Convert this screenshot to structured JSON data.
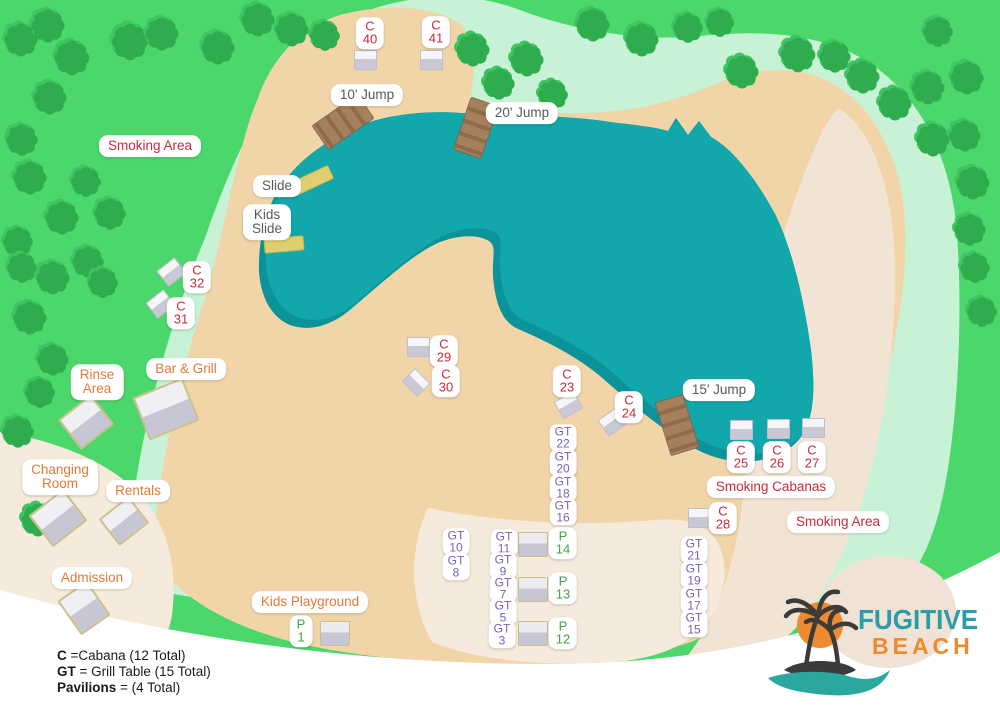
{
  "logo": {
    "line1": "FUGITIVE",
    "line2": "BEACH"
  },
  "legend": {
    "items": [
      {
        "term": "C",
        "rest": " =Cabana (12 Total)"
      },
      {
        "term": "GT",
        "rest": " = Grill Table (15 Total)"
      },
      {
        "term": "Pavilions",
        "rest": " = (4 Total)"
      }
    ]
  },
  "colors": {
    "grass": "#4BD76C",
    "tree": "#2FAC4E",
    "tree_halo": "#3EC562",
    "mint": "#C8F2D6",
    "sand": "#F1D5A9",
    "path_light": "#F5E9DB",
    "water": "#12A7AA",
    "water_deep": "#0C9399",
    "dock": "#A6805D",
    "slide": "#DFCF6E",
    "cabana_label": "#C62B3E",
    "facility_label": "#E07B39",
    "grill_table_label": "#7A5FB5",
    "pavilion_label": "#3FA344",
    "feature_label": "#57585A",
    "logo_teal": "#2A9DA8",
    "logo_orange": "#EE8A2F"
  },
  "map": {
    "labels": [
      {
        "id": "c40",
        "cls": "red",
        "x": 370,
        "y": 33,
        "lines": [
          "C",
          "40"
        ]
      },
      {
        "id": "c41",
        "cls": "red",
        "x": 436,
        "y": 32,
        "lines": [
          "C",
          "41"
        ]
      },
      {
        "id": "c32",
        "cls": "red",
        "x": 197,
        "y": 277,
        "lines": [
          "C",
          "32"
        ]
      },
      {
        "id": "c31",
        "cls": "red",
        "x": 181,
        "y": 313,
        "lines": [
          "C",
          "31"
        ]
      },
      {
        "id": "c29",
        "cls": "red",
        "x": 444,
        "y": 351,
        "lines": [
          "C",
          "29"
        ]
      },
      {
        "id": "c30",
        "cls": "red",
        "x": 446,
        "y": 381,
        "lines": [
          "C",
          "30"
        ]
      },
      {
        "id": "c23",
        "cls": "red",
        "x": 567,
        "y": 381,
        "lines": [
          "C",
          "23"
        ]
      },
      {
        "id": "c24",
        "cls": "red",
        "x": 629,
        "y": 407,
        "lines": [
          "C",
          "24"
        ]
      },
      {
        "id": "c25",
        "cls": "red",
        "x": 741,
        "y": 457,
        "lines": [
          "C",
          "25"
        ]
      },
      {
        "id": "c26",
        "cls": "red",
        "x": 777,
        "y": 457,
        "lines": [
          "C",
          "26"
        ]
      },
      {
        "id": "c27",
        "cls": "red",
        "x": 812,
        "y": 457,
        "lines": [
          "C",
          "27"
        ]
      },
      {
        "id": "c28",
        "cls": "red",
        "x": 723,
        "y": 518,
        "lines": [
          "C",
          "28"
        ]
      },
      {
        "id": "gt22",
        "cls": "purple small",
        "x": 563,
        "y": 438,
        "lines": [
          "GT",
          "22"
        ]
      },
      {
        "id": "gt20",
        "cls": "purple small",
        "x": 563,
        "y": 463,
        "lines": [
          "GT",
          "20"
        ]
      },
      {
        "id": "gt18",
        "cls": "purple small",
        "x": 563,
        "y": 488,
        "lines": [
          "GT",
          "18"
        ]
      },
      {
        "id": "gt16",
        "cls": "purple small",
        "x": 563,
        "y": 512,
        "lines": [
          "GT",
          "16"
        ]
      },
      {
        "id": "gt10",
        "cls": "purple small",
        "x": 456,
        "y": 542,
        "lines": [
          "GT",
          "10"
        ]
      },
      {
        "id": "gt8",
        "cls": "purple small",
        "x": 456,
        "y": 567,
        "lines": [
          "GT",
          "8"
        ]
      },
      {
        "id": "gt11",
        "cls": "purple small",
        "x": 504,
        "y": 543,
        "lines": [
          "GT",
          "11"
        ]
      },
      {
        "id": "gt9",
        "cls": "purple small",
        "x": 503,
        "y": 566,
        "lines": [
          "GT",
          "9"
        ]
      },
      {
        "id": "gt7",
        "cls": "purple small",
        "x": 503,
        "y": 589,
        "lines": [
          "GT",
          "7"
        ]
      },
      {
        "id": "gt5",
        "cls": "purple small",
        "x": 503,
        "y": 612,
        "lines": [
          "GT",
          "5"
        ]
      },
      {
        "id": "gt3",
        "cls": "purple small",
        "x": 502,
        "y": 635,
        "lines": [
          "GT",
          "3"
        ]
      },
      {
        "id": "gt21",
        "cls": "purple small",
        "x": 694,
        "y": 550,
        "lines": [
          "GT",
          "21"
        ]
      },
      {
        "id": "gt19",
        "cls": "purple small",
        "x": 694,
        "y": 575,
        "lines": [
          "GT",
          "19"
        ]
      },
      {
        "id": "gt17",
        "cls": "purple small",
        "x": 694,
        "y": 600,
        "lines": [
          "GT",
          "17"
        ]
      },
      {
        "id": "gt15",
        "cls": "purple small",
        "x": 694,
        "y": 624,
        "lines": [
          "GT",
          "15"
        ]
      },
      {
        "id": "p1",
        "cls": "green",
        "x": 301,
        "y": 631,
        "lines": [
          "P",
          "1"
        ]
      },
      {
        "id": "p14",
        "cls": "green",
        "x": 563,
        "y": 543,
        "lines": [
          "P",
          "14"
        ]
      },
      {
        "id": "p13",
        "cls": "green",
        "x": 563,
        "y": 588,
        "lines": [
          "P",
          "13"
        ]
      },
      {
        "id": "p12",
        "cls": "green",
        "x": 563,
        "y": 633,
        "lines": [
          "P",
          "12"
        ]
      },
      {
        "id": "smoking-area-west",
        "cls": "red wide",
        "x": 150,
        "y": 146,
        "lines": [
          "Smoking Area"
        ]
      },
      {
        "id": "smoking-cabanas",
        "cls": "red wide",
        "x": 771,
        "y": 487,
        "lines": [
          "Smoking Cabanas"
        ]
      },
      {
        "id": "smoking-area-east",
        "cls": "red wide",
        "x": 838,
        "y": 522,
        "lines": [
          "Smoking Area"
        ]
      },
      {
        "id": "rinse-area",
        "cls": "orange wide",
        "x": 97,
        "y": 382,
        "lines": [
          "Rinse",
          "Area"
        ]
      },
      {
        "id": "bar-and-grill",
        "cls": "orange wide",
        "x": 186,
        "y": 369,
        "lines": [
          "Bar & Grill"
        ]
      },
      {
        "id": "changing-room",
        "cls": "orange wide",
        "x": 60,
        "y": 477,
        "lines": [
          "Changing",
          "Room"
        ]
      },
      {
        "id": "rentals",
        "cls": "orange wide",
        "x": 138,
        "y": 491,
        "lines": [
          "Rentals"
        ]
      },
      {
        "id": "admission",
        "cls": "orange wide",
        "x": 92,
        "y": 578,
        "lines": [
          "Admission"
        ]
      },
      {
        "id": "kids-playground",
        "cls": "orange wide",
        "x": 310,
        "y": 602,
        "lines": [
          "Kids Playground"
        ]
      },
      {
        "id": "jump-10",
        "cls": "gray wide",
        "x": 367,
        "y": 95,
        "lines": [
          "10' Jump"
        ]
      },
      {
        "id": "jump-20",
        "cls": "gray wide",
        "x": 522,
        "y": 113,
        "lines": [
          "20' Jump"
        ]
      },
      {
        "id": "jump-15",
        "cls": "gray wide",
        "x": 719,
        "y": 390,
        "lines": [
          "15' Jump"
        ]
      },
      {
        "id": "slide",
        "cls": "gray wide",
        "x": 277,
        "y": 186,
        "lines": [
          "Slide"
        ]
      },
      {
        "id": "kids-slide",
        "cls": "gray wide",
        "x": 267,
        "y": 222,
        "lines": [
          "Kids",
          "Slide"
        ]
      }
    ],
    "structures": [
      {
        "id": "c40",
        "type": "cabana",
        "x": 364,
        "y": 59,
        "w": 21,
        "h": 18,
        "r": 0
      },
      {
        "id": "c41",
        "type": "cabana",
        "x": 430,
        "y": 59,
        "w": 21,
        "h": 18,
        "r": 0
      },
      {
        "id": "c32",
        "type": "cabana",
        "x": 170,
        "y": 271,
        "w": 21,
        "h": 18,
        "r": -38
      },
      {
        "id": "c31",
        "type": "cabana",
        "x": 159,
        "y": 303,
        "w": 21,
        "h": 18,
        "r": -38
      },
      {
        "id": "c29",
        "type": "cabana",
        "x": 417,
        "y": 346,
        "w": 21,
        "h": 18,
        "r": 0
      },
      {
        "id": "c30",
        "type": "cabana",
        "x": 415,
        "y": 381,
        "w": 20,
        "h": 17,
        "r": 45
      },
      {
        "id": "c23",
        "type": "cabana",
        "x": 567,
        "y": 404,
        "w": 21,
        "h": 18,
        "r": -30
      },
      {
        "id": "c24",
        "type": "cabana",
        "x": 611,
        "y": 421,
        "w": 21,
        "h": 18,
        "r": -35
      },
      {
        "id": "c25",
        "type": "cabana",
        "x": 740,
        "y": 429,
        "w": 21,
        "h": 18,
        "r": 0
      },
      {
        "id": "c26",
        "type": "cabana",
        "x": 777,
        "y": 428,
        "w": 21,
        "h": 18,
        "r": 0
      },
      {
        "id": "c27",
        "type": "cabana",
        "x": 812,
        "y": 427,
        "w": 21,
        "h": 18,
        "r": 0
      },
      {
        "id": "c28",
        "type": "cabana",
        "x": 698,
        "y": 517,
        "w": 21,
        "h": 18,
        "r": 0
      },
      {
        "id": "bar-and-grill",
        "type": "building",
        "x": 164,
        "y": 407,
        "w": 50,
        "h": 42,
        "r": -22
      },
      {
        "id": "rinse-area",
        "type": "building",
        "x": 84,
        "y": 420,
        "w": 38,
        "h": 34,
        "r": -38
      },
      {
        "id": "changing-room",
        "type": "building",
        "x": 56,
        "y": 516,
        "w": 40,
        "h": 36,
        "r": -38
      },
      {
        "id": "rentals",
        "type": "building",
        "x": 122,
        "y": 519,
        "w": 34,
        "h": 30,
        "r": -38
      },
      {
        "id": "admission",
        "type": "building",
        "x": 82,
        "y": 606,
        "w": 32,
        "h": 38,
        "r": -35
      },
      {
        "id": "p1",
        "type": "pavilion",
        "x": 334,
        "y": 632,
        "w": 28,
        "h": 23,
        "r": 0
      },
      {
        "id": "p14",
        "type": "pavilion",
        "x": 532,
        "y": 543,
        "w": 28,
        "h": 23,
        "r": 0
      },
      {
        "id": "p13",
        "type": "pavilion",
        "x": 532,
        "y": 588,
        "w": 28,
        "h": 23,
        "r": 0
      },
      {
        "id": "p12",
        "type": "pavilion",
        "x": 532,
        "y": 632,
        "w": 28,
        "h": 23,
        "r": 0
      },
      {
        "id": "jump-10",
        "type": "dock",
        "x": 342,
        "y": 121,
        "w": 28,
        "h": 54,
        "r": 55
      },
      {
        "id": "jump-20",
        "type": "dock",
        "x": 475,
        "y": 127,
        "w": 28,
        "h": 54,
        "r": 19
      },
      {
        "id": "jump-15",
        "type": "dock",
        "x": 676,
        "y": 424,
        "w": 28,
        "h": 54,
        "r": -17
      },
      {
        "id": "slide-big",
        "type": "slide",
        "x": 311,
        "y": 179,
        "w": 40,
        "h": 13,
        "r": -25
      },
      {
        "id": "slide-kids",
        "type": "slide",
        "x": 283,
        "y": 243,
        "w": 38,
        "h": 13,
        "r": -5
      }
    ],
    "trees": [
      [
        21,
        40,
        1
      ],
      [
        48,
        26,
        1
      ],
      [
        72,
        58,
        1.05
      ],
      [
        130,
        42,
        1.1
      ],
      [
        162,
        34,
        1
      ],
      [
        218,
        48,
        1
      ],
      [
        258,
        20,
        1
      ],
      [
        292,
        30,
        1
      ],
      [
        325,
        36,
        0.9
      ],
      [
        473,
        50,
        1
      ],
      [
        499,
        84,
        0.95
      ],
      [
        527,
        60,
        1
      ],
      [
        553,
        95,
        0.9
      ],
      [
        593,
        25,
        1
      ],
      [
        642,
        40,
        1
      ],
      [
        688,
        28,
        0.9
      ],
      [
        720,
        23,
        0.85
      ],
      [
        742,
        72,
        1
      ],
      [
        798,
        55,
        1.05
      ],
      [
        835,
        57,
        0.95
      ],
      [
        863,
        77,
        1
      ],
      [
        895,
        104,
        1
      ],
      [
        928,
        88,
        1
      ],
      [
        938,
        32,
        0.9
      ],
      [
        967,
        78,
        1
      ],
      [
        50,
        98,
        1
      ],
      [
        22,
        140,
        0.95
      ],
      [
        30,
        178,
        1
      ],
      [
        62,
        218,
        1
      ],
      [
        86,
        182,
        0.9
      ],
      [
        110,
        214,
        0.95
      ],
      [
        18,
        242,
        0.9
      ],
      [
        22,
        268,
        0.9
      ],
      [
        53,
        278,
        1
      ],
      [
        88,
        262,
        0.95
      ],
      [
        103,
        283,
        0.9
      ],
      [
        30,
        318,
        1
      ],
      [
        53,
        360,
        0.95
      ],
      [
        40,
        393,
        0.9
      ],
      [
        18,
        432,
        0.95
      ],
      [
        38,
        520,
        1
      ],
      [
        933,
        140,
        1
      ],
      [
        965,
        136,
        0.95
      ],
      [
        973,
        183,
        1
      ],
      [
        970,
        230,
        0.95
      ],
      [
        975,
        268,
        0.9
      ],
      [
        982,
        312,
        0.9
      ]
    ]
  }
}
